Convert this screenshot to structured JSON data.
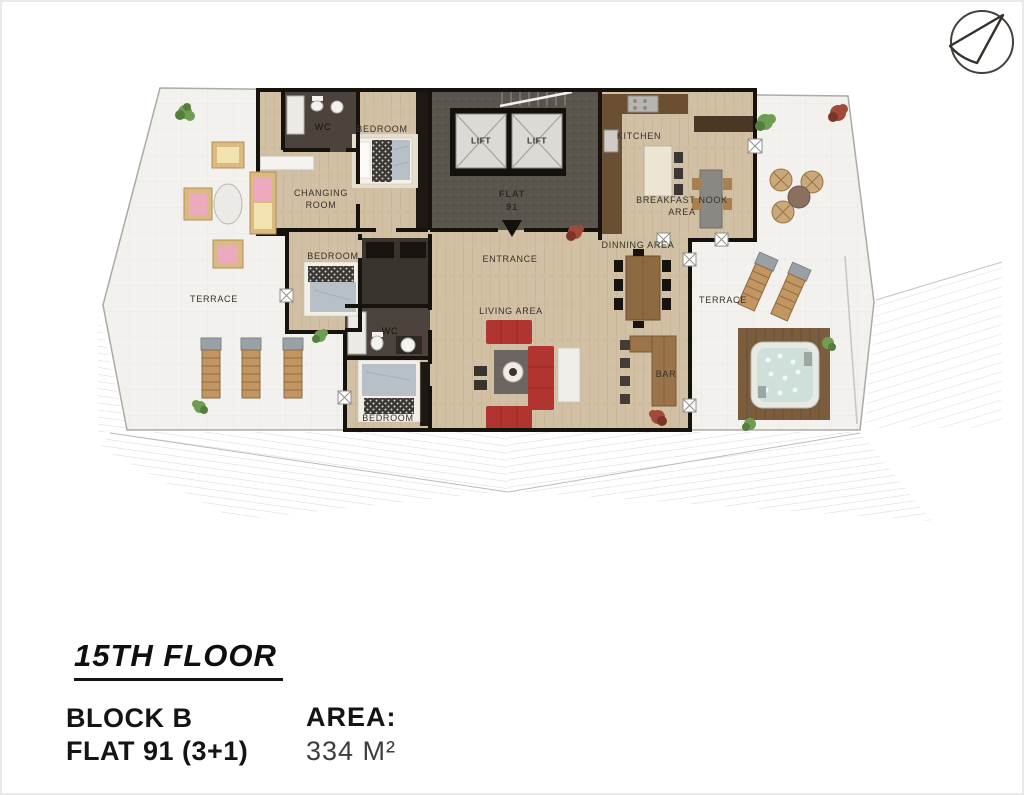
{
  "compass": {
    "icon": "north-arrow"
  },
  "plan": {
    "rooms": {
      "wc_top": "WC",
      "bedroom_top": "BEDROOM",
      "changing_room": "CHANGING ROOM",
      "lift_left": "LIFT",
      "lift_right": "LIFT",
      "flat_core": "FLAT 91",
      "kitchen": "KITCHEN",
      "breakfast_nook": "BREAKFAST NOOK AREA",
      "entrance": "ENTRANCE",
      "dinning_area": "DINNING AREA",
      "living_area": "LIVING AREA",
      "terrace_left": "TERRACE",
      "terrace_right": "TERRACE",
      "bedroom_mid": "BEDROOM",
      "wc_bottom": "WC",
      "bedroom_bottom": "BEDROOM",
      "bar": "BAR"
    }
  },
  "footer": {
    "floor_title": "15TH FLOOR",
    "block": "BLOCK B",
    "flat": "FLAT 91 (3+1)",
    "area_label": "AREA:",
    "area_value": "334 M²"
  },
  "colors": {
    "wall": "#16120d",
    "wood_floor": "#d1c0a4",
    "terrace_floor": "#f2f1ee",
    "core_gray": "#59544c",
    "sofa_red": "#b23430",
    "bar_wood": "#9a7348",
    "water": "#cfe0da",
    "plant_green": "#6f9d53",
    "plant_red": "#a04a39"
  }
}
